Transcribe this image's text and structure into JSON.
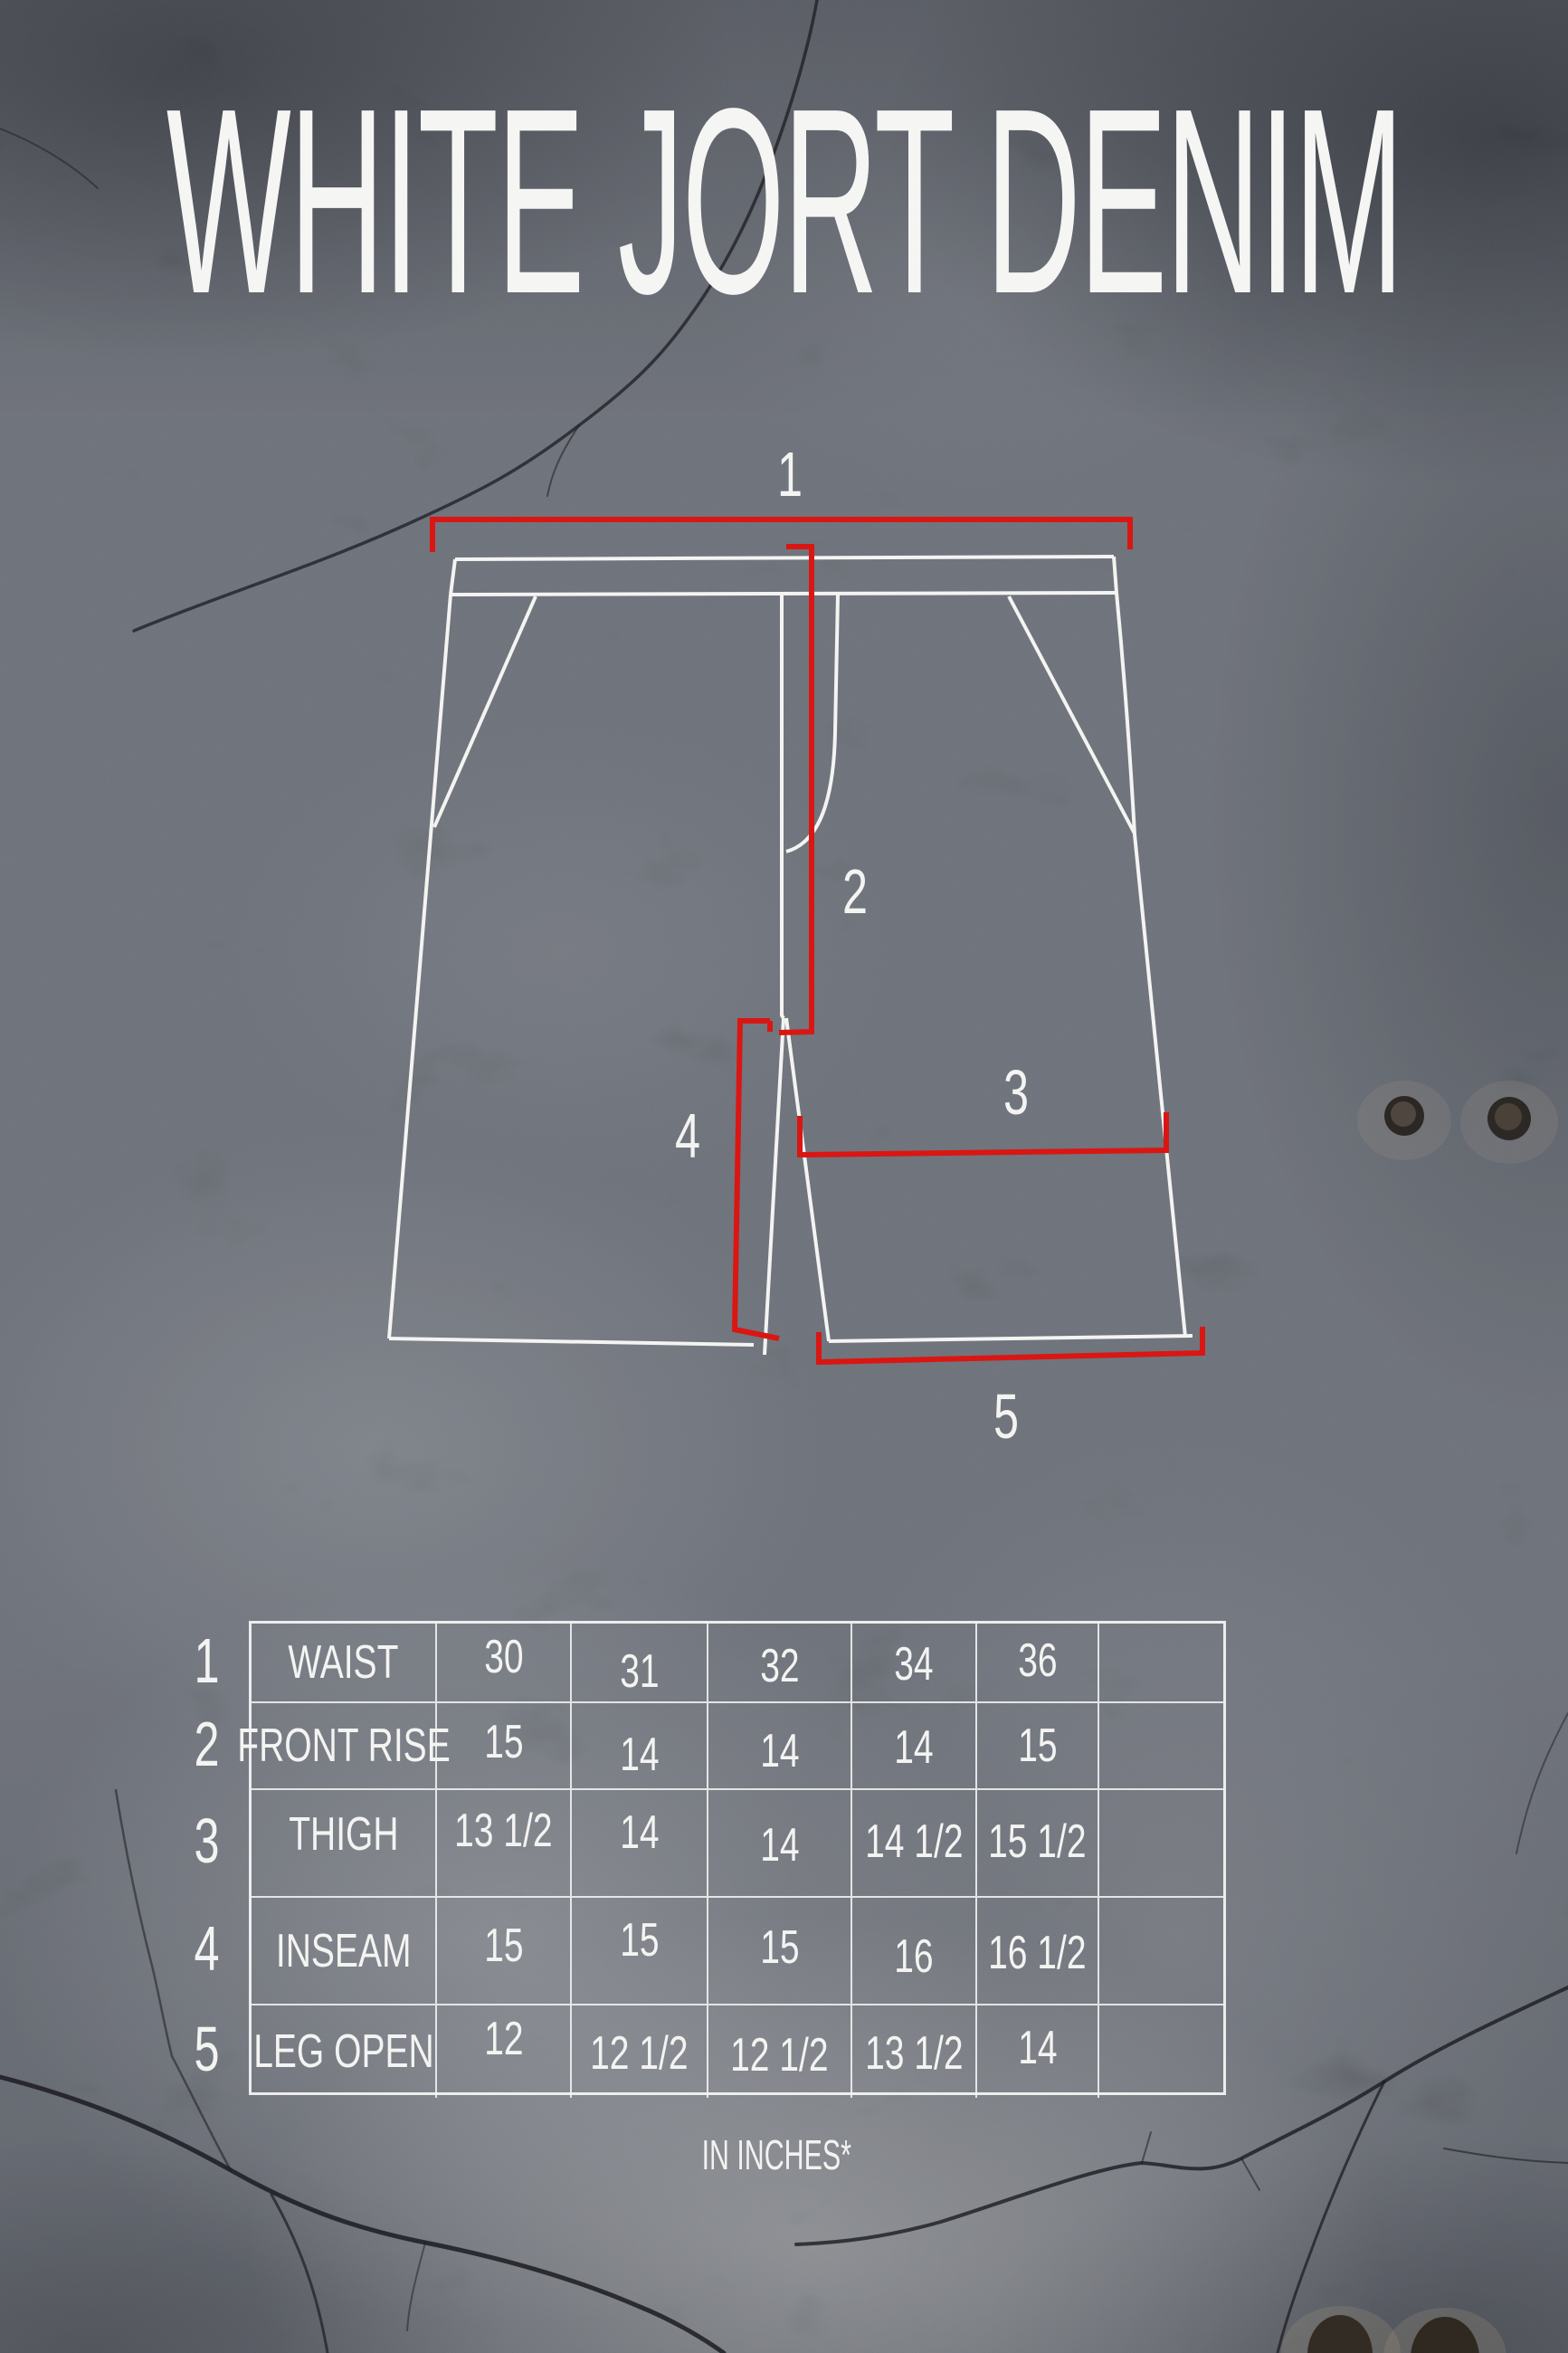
{
  "poster": {
    "title": "WHITE JORT DENIM",
    "units_note": "IN INCHES*"
  },
  "diagram": {
    "markers": [
      "1",
      "2",
      "3",
      "4",
      "5"
    ]
  },
  "size_table": {
    "rows": [
      {
        "num": "1",
        "label": "WAIST",
        "values": [
          "30",
          "31",
          "32",
          "34",
          "36",
          ""
        ]
      },
      {
        "num": "2",
        "label": "FRONT RISE",
        "values": [
          "15",
          "14",
          "14",
          "14",
          "15",
          ""
        ]
      },
      {
        "num": "3",
        "label": "THIGH",
        "values": [
          "13 1/2",
          "14",
          "14",
          "14 1/2",
          "15 1/2",
          ""
        ]
      },
      {
        "num": "4",
        "label": "INSEAM",
        "values": [
          "15",
          "15",
          "15",
          "16",
          "16 1/2",
          ""
        ]
      },
      {
        "num": "5",
        "label": "LEG OPEN",
        "values": [
          "12",
          "12 1/2",
          "12 1/2",
          "13 1/2",
          "14",
          ""
        ]
      }
    ]
  },
  "colors": {
    "background": "#53565b",
    "line_white": "#f3f3f1",
    "accent_red": "#d81310"
  }
}
